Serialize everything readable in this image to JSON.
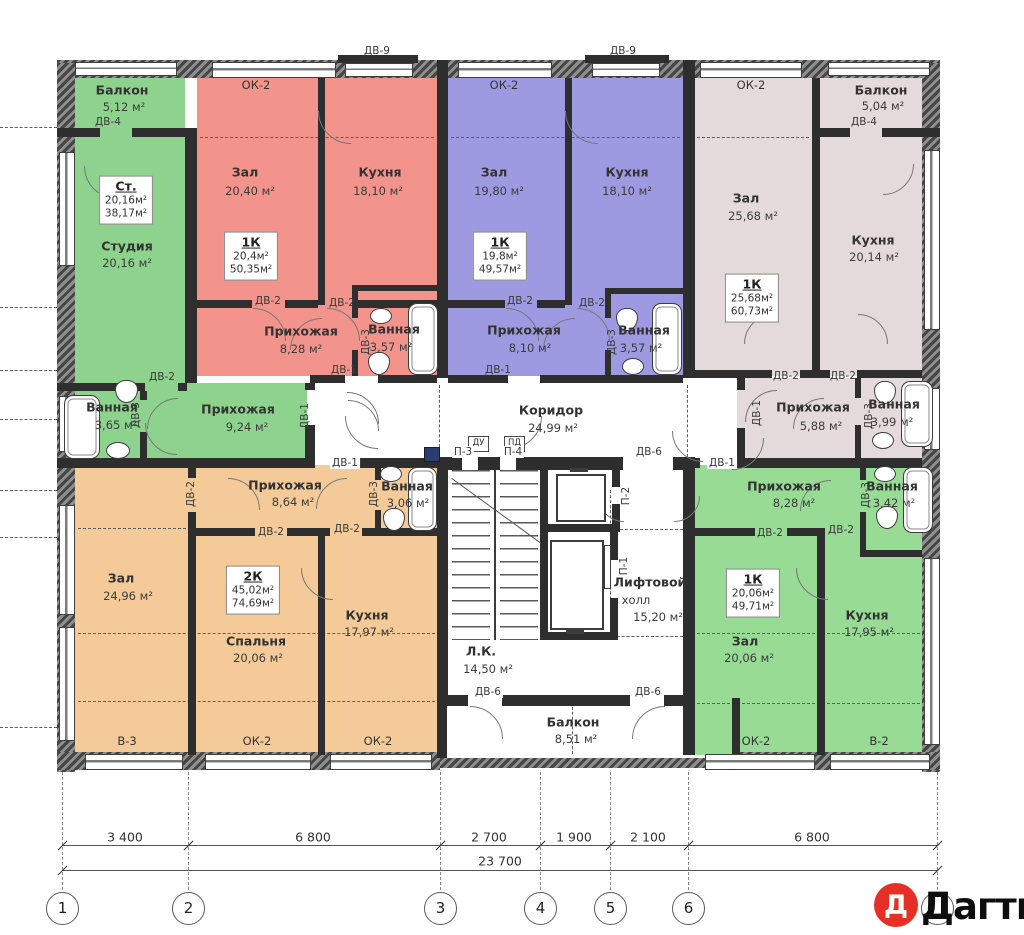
{
  "colors": {
    "studio_green": "#8dd38d",
    "apartment_green": "#97db95",
    "apartment_red": "#f2948c",
    "apartment_blue": "#9e9ae1",
    "apartment_mauve": "#e4dadb",
    "apartment_orange": "#f5ca99",
    "wall_dark": "#2e2e2e",
    "logo_red": "#e63026"
  },
  "rooms": {
    "hall": "Зал",
    "kitchen": "Кухня",
    "hallway": "Прихожая",
    "bath": "Ванная",
    "bedroom": "Спальня",
    "balcony": "Балкон",
    "studio": "Студия",
    "corridor": "Коридор",
    "stairs": "Л.К.",
    "lift1": "Лифтовой",
    "lift2": "холл"
  },
  "doors": {
    "dv1": "ДВ-1",
    "dv2": "ДВ-2",
    "dv3": "ДВ-3",
    "dv4": "ДВ-4",
    "dv6": "ДВ-6",
    "dv9": "ДВ-9"
  },
  "panels": {
    "p1": "П-1",
    "p2": "П-2",
    "p3": "П-3",
    "p4": "П-4",
    "du": "ДУ",
    "pd": "ПД"
  },
  "windows": {
    "ok2": "ОК-2",
    "v2": "В-2",
    "v3": "В-3"
  },
  "studio": {
    "type": "Ст.",
    "living": "20,16м²",
    "total": "38,17м²",
    "room_area": "20,16 м²",
    "balcony_area": "5,12 м²"
  },
  "apt_red": {
    "type": "1К",
    "living": "20,4м²",
    "total": "50,35м²",
    "hall_area": "20,40 м²",
    "kitchen_area": "18,10 м²",
    "hallway_area": "8,28 м²",
    "bath_area": "3,57 м²"
  },
  "apt_blue": {
    "type": "1К",
    "living": "19,8м²",
    "total": "49,57м²",
    "hall_area": "19,80 м²",
    "kitchen_area": "18,10 м²",
    "hallway_area": "8,10 м²",
    "bath_area": "3,57 м²"
  },
  "apt_mauve": {
    "type": "1К",
    "living": "25,68м²",
    "total": "60,73м²",
    "hall_area": "25,68 м²",
    "kitchen_area": "20,14 м²",
    "hallway_area": "5,88 м²",
    "bath_area": "3,99 м²",
    "balcony_area": "5,04 м²"
  },
  "apt_orange": {
    "type": "2К",
    "living": "45,02м²",
    "total": "74,69м²",
    "hall_area": "24,96 м²",
    "bedroom_area": "20,06 м²",
    "kitchen_area": "17,97 м²",
    "hallway_area": "8,64 м²",
    "bath_area": "3,06 м²"
  },
  "apt_green": {
    "type": "1К",
    "living": "20,06м²",
    "total": "49,71м²",
    "hall_area": "20,06 м²",
    "kitchen_area": "17,95 м²",
    "hallway_area": "8,28 м²",
    "bath_area": "3,42 м²"
  },
  "common": {
    "shared_hallway_area": "9,24 м²",
    "shared_bath_area": "3,65 м²",
    "corridor_area": "24,99 м²",
    "stairs_area": "14,50 м²",
    "lift_area": "15,20 м²",
    "balcony_area": "8,51 м²"
  },
  "dimensions": {
    "d1": "3 400",
    "d2": "6 800",
    "d3": "2 700",
    "d4": "1 900",
    "d5": "2 100",
    "d6": "6 800",
    "total": "23 700"
  },
  "axes": [
    "1",
    "2",
    "3",
    "4",
    "5",
    "6"
  ],
  "logo": {
    "letter": "Д",
    "name": "Дагти"
  }
}
